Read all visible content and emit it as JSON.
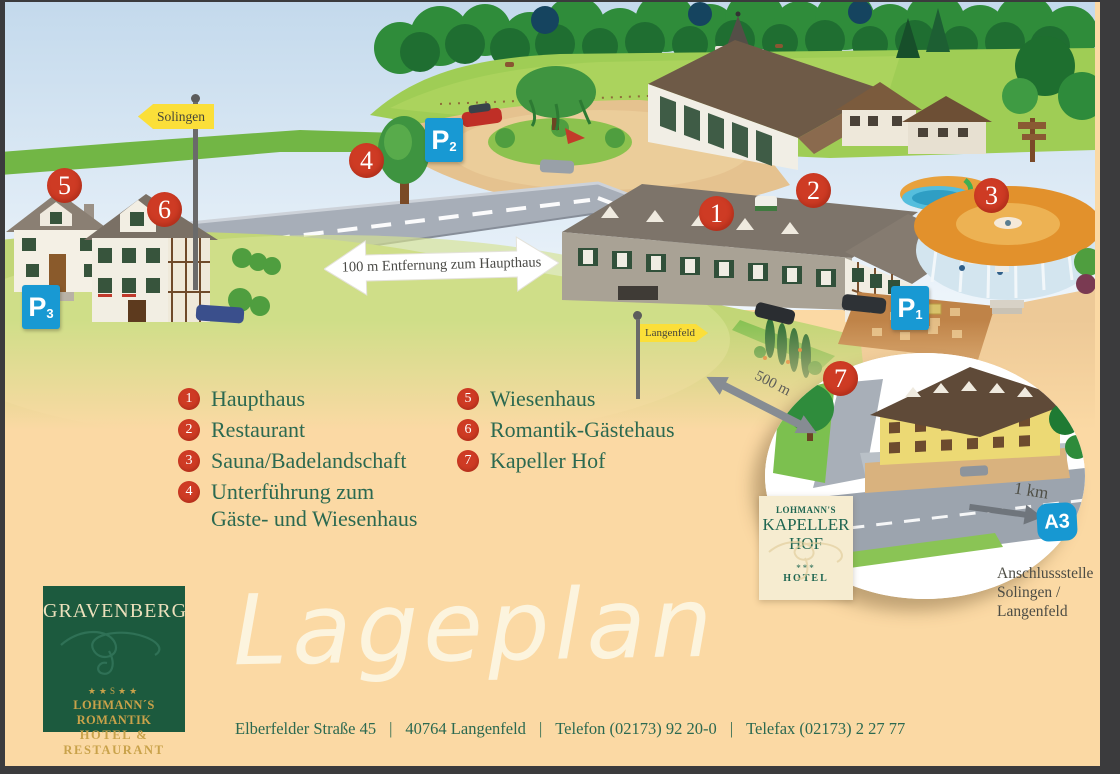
{
  "colors": {
    "marker_red": "#ce3b24",
    "parking_blue": "#1899d3",
    "sign_yellow": "#fbdf39",
    "legend_green": "#2b6950",
    "logo_green": "#1c5a3e",
    "gold": "#c9a24a",
    "page_background": "#fbd9a4"
  },
  "map": {
    "markers": [
      {
        "label": "1"
      },
      {
        "label": "2"
      },
      {
        "label": "3"
      },
      {
        "label": "4"
      },
      {
        "label": "5"
      },
      {
        "label": "6"
      },
      {
        "label": "7"
      }
    ],
    "parking_signs": [
      {
        "letter": "P",
        "index": "1"
      },
      {
        "letter": "P",
        "index": "2"
      },
      {
        "letter": "P",
        "index": "3"
      }
    ],
    "signs": {
      "solingen": "Solingen",
      "langenfeld": "Langenfeld"
    },
    "distances": {
      "haupthaus_arrow": "100 m Entfernung zum Haupthaus",
      "road_arrow": "500 m",
      "inset_arrow": "1 km"
    },
    "motorway_badge": "A3",
    "inset_sign": {
      "brand": "LOHMANN'S",
      "name_line1": "KAPELLER",
      "name_line2": "HOF",
      "stars": "***",
      "category": "HOTEL"
    },
    "junction": {
      "line1": "Anschlussstelle",
      "line2": "Solingen /",
      "line3": "Langenfeld"
    }
  },
  "legend": {
    "left": [
      {
        "num": "1",
        "label": "Haupthaus"
      },
      {
        "num": "2",
        "label": "Restaurant"
      },
      {
        "num": "3",
        "label": "Sauna/Badelandschaft"
      },
      {
        "num": "4",
        "label": "Unterführung zum",
        "label2": "Gäste- und Wiesenhaus"
      }
    ],
    "right": [
      {
        "num": "5",
        "label": "Wiesenhaus"
      },
      {
        "num": "6",
        "label": "Romantik-Gästehaus"
      },
      {
        "num": "7",
        "label": "Kapeller Hof"
      }
    ]
  },
  "logo": {
    "name": "GRAVENBERG",
    "stars": "★★S★★",
    "subtitle1": "LOHMANN´S ROMANTIK",
    "subtitle2": "HOTEL & RESTAURANT"
  },
  "title": "Lageplan",
  "footer": {
    "sep": "|",
    "parts": [
      "Elberfelder Straße 45",
      "40764 Langenfeld",
      "Telefon (02173) 92 20-0",
      "Telefax (02173) 2 27 77"
    ]
  }
}
